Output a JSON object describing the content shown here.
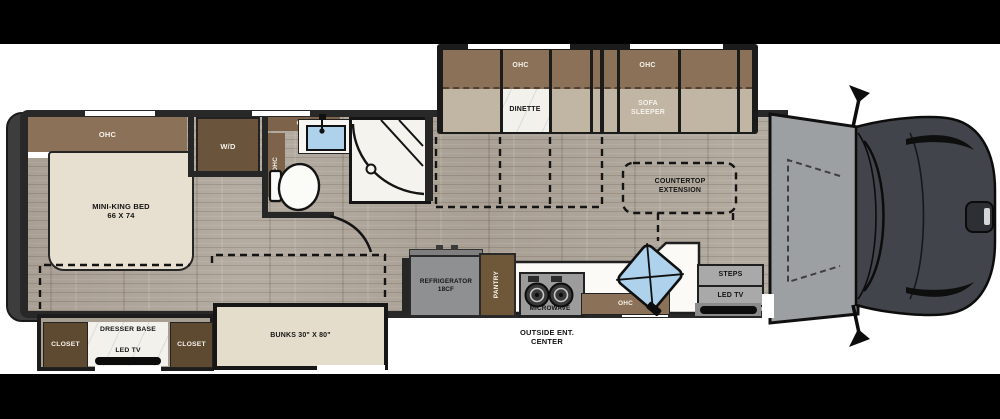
{
  "diagram_type": "rv-floorplan-top-view",
  "labels": {
    "bedroom_ohc": "OHC",
    "bed_name": "MINI-KING BED",
    "bed_size": "66 X 74",
    "washer_dryer": "W/D",
    "bath_ohc_top": "OHC",
    "bath_ohc_side": "OHC",
    "dinette_ohc": "OHC",
    "dinette": "DINETTE",
    "sofa_ohc": "OHC",
    "sofa_line1": "SOFA",
    "sofa_line2": "SLEEPER",
    "countertop_line1": "COUNTERTOP",
    "countertop_line2": "EXTENSION",
    "fridge_line1": "REFRIGERATOR",
    "fridge_line2": "18CF",
    "pantry": "PANTRY",
    "microwave": "MICROWAVE",
    "kitchen_ohc": "OHC",
    "steps": "STEPS",
    "entry_led_tv": "LED TV",
    "outside_line1": "OUTSIDE ENT.",
    "outside_line2": "CENTER",
    "closet_left": "CLOSET",
    "dresser_base": "DRESSER BASE",
    "bedroom_led_tv": "LED TV",
    "closet_right": "CLOSET",
    "bunks": "BUNKS 30\" X 80\""
  },
  "colors": {
    "cabinet_brown": "#8a7157",
    "dark_wood_brown": "#5e4931",
    "floor_wood": "#b0a79c",
    "bed_beige": "#e7dfcf",
    "cushion_taupe": "#c1b5a4",
    "appliance_gray": "#8f9091",
    "sink_blue": "#aed2ec",
    "wall_dark": "#262626",
    "truck_gray": "#41444a",
    "caboverhang_gray": "#9da0a2",
    "mask_black": "#000000"
  }
}
